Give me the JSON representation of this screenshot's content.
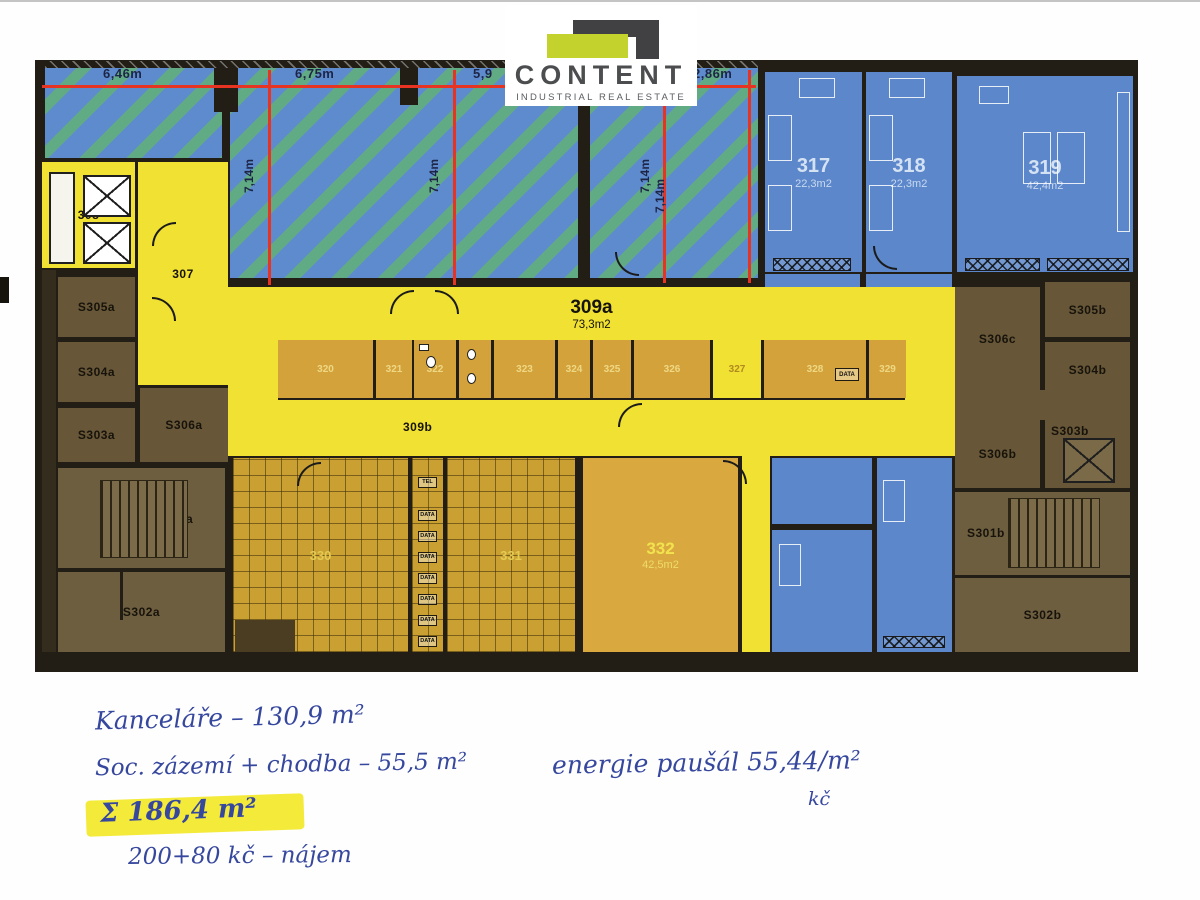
{
  "logo": {
    "name": "CONTENT",
    "tagline": "INDUSTRIAL REAL ESTATE"
  },
  "dimensions": {
    "d1": "6,46m",
    "d2": "6,75m",
    "d3": "5,9",
    "d4": "2,86m",
    "v1": "7,14m",
    "v2": "7,14m",
    "v3": "7,14m",
    "v4": "7,14m"
  },
  "rooms": {
    "r307": "307",
    "r308": "308",
    "r309a": "309a",
    "r309a_area": "73,3m2",
    "r309b": "309b",
    "r317": "317",
    "r317_area": "22,3m2",
    "r318": "318",
    "r318_area": "22,3m2",
    "r319": "319",
    "r319_area": "42,4m2",
    "r320": "320",
    "r321": "321",
    "r322": "322",
    "r323": "323",
    "r324": "324",
    "r325": "325",
    "r326": "326",
    "r327": "327",
    "r328": "328",
    "r329": "329",
    "r330": "330",
    "r331": "331",
    "r332": "332",
    "r332_area": "42,5m2",
    "s301a": "S301a",
    "s302a": "S302a",
    "s303a": "S303a",
    "s304a": "S304a",
    "s305a": "S305a",
    "s306a": "S306a",
    "s301b": "S301b",
    "s302b": "S302b",
    "s303b": "S303b",
    "s304b": "S304b",
    "s305b": "S305b",
    "s306b": "S306b",
    "s306c": "S306c"
  },
  "equipment": {
    "tel": "TEL",
    "data": "DATA"
  },
  "notes": {
    "line1": "Kanceláře  –  130,9 m²",
    "line2": "Soc. zázemí + chodba  –  55,5 m²",
    "line3": "Σ 186,4 m²",
    "line4": "200+80 kč  –  nájem",
    "line5": "energie paušál   55,44/m²",
    "line6": "kč"
  },
  "colors": {
    "accent_red": "#e63322",
    "plan_yellow": "#f0e132",
    "plan_blue": "#5c88cb",
    "plan_orange": "#d4a23a",
    "plan_brown": "#675738",
    "logo_green": "#c3d22d"
  }
}
